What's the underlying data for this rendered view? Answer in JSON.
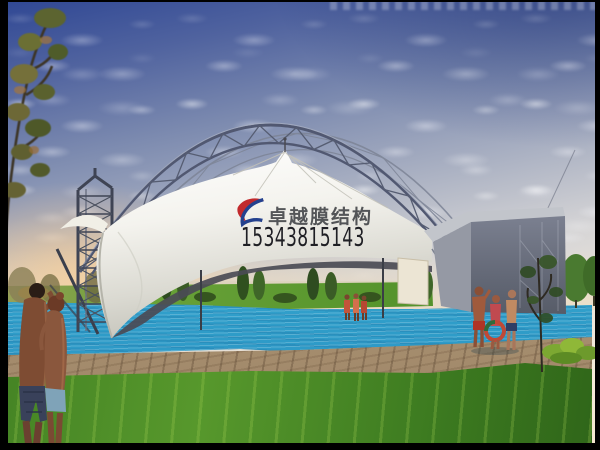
{
  "watermark": {
    "brand": "卓越膜结构",
    "phone": "15343815143"
  },
  "colors": {
    "logo_red": "#c22a2d",
    "logo_blue": "#24418e",
    "sky_top": "#2f4794",
    "sky_horizon": "#f6ecd9",
    "sunset_glow": "#ffcd8c",
    "membrane_white": "#f2f1ec",
    "steel_truss": "#4c536a",
    "pool_water": "#3aa9d0",
    "grass_green": "#4a8a26",
    "deck_tan": "#b49a78",
    "wall_gray": "#6e7380"
  }
}
